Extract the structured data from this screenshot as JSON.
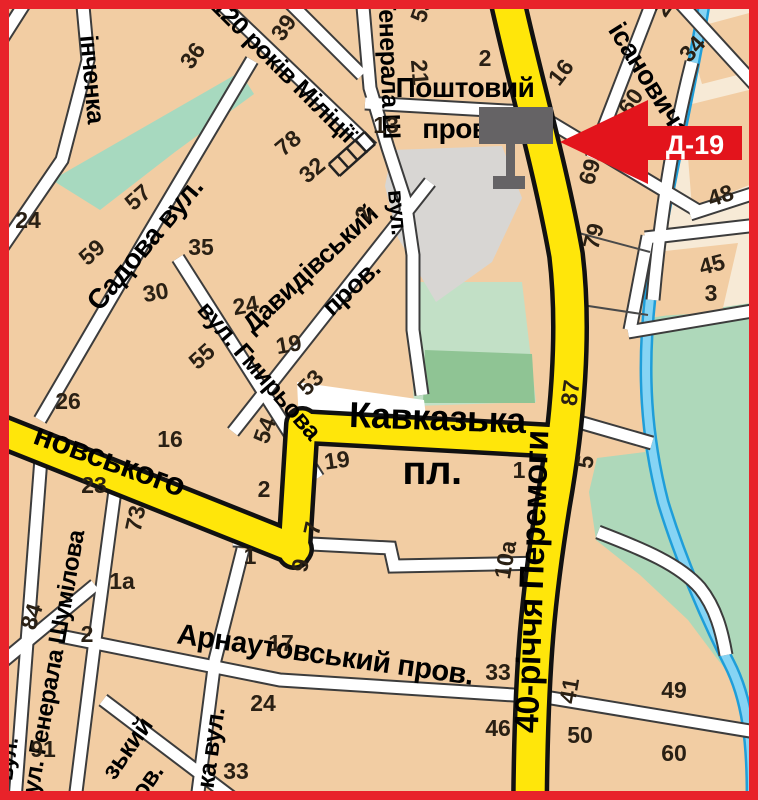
{
  "title": "city-map-billboard-location",
  "marker": {
    "code": "Д-19"
  },
  "colors": {
    "border_red": "#e8232a",
    "land_tan": "#f2cda3",
    "land_cream": "#f7ead6",
    "road_yellow": "#ffe60a",
    "street_white": "#ffffff",
    "park_green": "#aed8ba",
    "park_green_light": "#c2e0c6",
    "park_green_dark": "#8fc494",
    "water_blue": "#86d4f4",
    "water_edge": "#1f9ed9",
    "gray_zone": "#d8d6d3",
    "billboard_gray": "#656365",
    "marker_red": "#e3141c"
  },
  "street_labels": [
    {
      "text": "інченка",
      "x": 84,
      "y": 80,
      "rot": 85,
      "size": 25
    },
    {
      "text": "Садова вул.",
      "x": 152,
      "y": 250,
      "rot": -50,
      "size": 28
    },
    {
      "text": "120 років Міліції",
      "x": 278,
      "y": 76,
      "rot": 45,
      "size": 25
    },
    {
      "text": "Генерала Ш",
      "x": 381,
      "y": 68,
      "rot": 88,
      "size": 25
    },
    {
      "text": "вул.",
      "x": 390,
      "y": 213,
      "rot": 85,
      "size": 23
    },
    {
      "text": "Поштовий",
      "x": 465,
      "y": 97,
      "rot": 0,
      "size": 28
    },
    {
      "text": "пров.",
      "x": 459,
      "y": 138,
      "rot": 0,
      "size": 28
    },
    {
      "text": "ісановича",
      "x": 642,
      "y": 85,
      "rot": 58,
      "size": 27
    },
    {
      "text": "Давидівський",
      "x": 316,
      "y": 275,
      "rot": -43,
      "size": 26
    },
    {
      "text": "пров.",
      "x": 357,
      "y": 294,
      "rot": -43,
      "size": 26
    },
    {
      "text": "вул. Гмирьова",
      "x": 253,
      "y": 376,
      "rot": 49,
      "size": 25
    },
    {
      "text": "Кавказька",
      "x": 437,
      "y": 430,
      "rot": 2,
      "size": 36
    },
    {
      "text": "пл.",
      "x": 432,
      "y": 484,
      "rot": 0,
      "size": 40
    },
    {
      "text": "новського",
      "x": 106,
      "y": 470,
      "rot": 20,
      "size": 32
    },
    {
      "text": "40-річчя Перемоги",
      "x": 543,
      "y": 582,
      "rot": -88,
      "size": 34
    },
    {
      "text": "вул. Генерала Шумілова",
      "x": 60,
      "y": 670,
      "rot": -80,
      "size": 24
    },
    {
      "text": "Арнаутовський пров.",
      "x": 324,
      "y": 664,
      "rot": 8,
      "size": 29
    },
    {
      "text": "зький",
      "x": 134,
      "y": 753,
      "rot": -55,
      "size": 25
    },
    {
      "text": "ов.",
      "x": 154,
      "y": 786,
      "rot": -55,
      "size": 25
    },
    {
      "text": "ка вул.",
      "x": 219,
      "y": 749,
      "rot": -82,
      "size": 25
    },
    {
      "text": "вул.",
      "x": 15,
      "y": 760,
      "rot": -82,
      "size": 22
    }
  ],
  "house_numbers": [
    {
      "text": "36",
      "x": 199,
      "y": 60,
      "rot": -55
    },
    {
      "text": "39",
      "x": 290,
      "y": 32,
      "rot": -55
    },
    {
      "text": "78",
      "x": 293,
      "y": 149,
      "rot": -40
    },
    {
      "text": "32",
      "x": 317,
      "y": 176,
      "rot": -40
    },
    {
      "text": "24",
      "x": 28,
      "y": 228,
      "rot": 0
    },
    {
      "text": "57",
      "x": 143,
      "y": 203,
      "rot": -42
    },
    {
      "text": "59",
      "x": 97,
      "y": 258,
      "rot": -42
    },
    {
      "text": "35",
      "x": 201,
      "y": 255,
      "rot": 0
    },
    {
      "text": "30",
      "x": 157,
      "y": 300,
      "rot": -10
    },
    {
      "text": "55",
      "x": 207,
      "y": 362,
      "rot": -42
    },
    {
      "text": "53",
      "x": 429,
      "y": 12,
      "rot": -70
    },
    {
      "text": "21",
      "x": 412,
      "y": 73,
      "rot": 85
    },
    {
      "text": "2",
      "x": 485,
      "y": 66,
      "rot": 0
    },
    {
      "text": "13",
      "x": 386,
      "y": 133,
      "rot": 0
    },
    {
      "text": "16",
      "x": 567,
      "y": 77,
      "rot": -52
    },
    {
      "text": "2",
      "x": 669,
      "y": 13,
      "rot": -55
    },
    {
      "text": "34",
      "x": 698,
      "y": 54,
      "rot": -48
    },
    {
      "text": "60",
      "x": 637,
      "y": 106,
      "rot": -55
    },
    {
      "text": "69",
      "x": 597,
      "y": 174,
      "rot": -73
    },
    {
      "text": "79",
      "x": 601,
      "y": 238,
      "rot": -76
    },
    {
      "text": "48",
      "x": 723,
      "y": 203,
      "rot": -18
    },
    {
      "text": "45",
      "x": 714,
      "y": 272,
      "rot": -15
    },
    {
      "text": "3",
      "x": 711,
      "y": 301,
      "rot": 0
    },
    {
      "text": "87",
      "x": 578,
      "y": 394,
      "rot": -82
    },
    {
      "text": "5",
      "x": 593,
      "y": 463,
      "rot": -82
    },
    {
      "text": "2",
      "x": 371,
      "y": 216,
      "rot": -70
    },
    {
      "text": "24",
      "x": 247,
      "y": 313,
      "rot": -10
    },
    {
      "text": "19",
      "x": 290,
      "y": 352,
      "rot": -10
    },
    {
      "text": "53",
      "x": 316,
      "y": 388,
      "rot": -45
    },
    {
      "text": "26",
      "x": 68,
      "y": 409,
      "rot": 0
    },
    {
      "text": "16",
      "x": 170,
      "y": 447,
      "rot": 0
    },
    {
      "text": "54",
      "x": 272,
      "y": 433,
      "rot": -70
    },
    {
      "text": "23",
      "x": 94,
      "y": 493,
      "rot": 0
    },
    {
      "text": "73",
      "x": 143,
      "y": 520,
      "rot": -78
    },
    {
      "text": "2",
      "x": 264,
      "y": 497,
      "rot": 0
    },
    {
      "text": "1",
      "x": 250,
      "y": 564,
      "rot": 0
    },
    {
      "text": "1а",
      "x": 122,
      "y": 589,
      "rot": 0
    },
    {
      "text": "19",
      "x": 338,
      "y": 468,
      "rot": -8
    },
    {
      "text": "7",
      "x": 320,
      "y": 530,
      "rot": -78
    },
    {
      "text": "9",
      "x": 308,
      "y": 567,
      "rot": -78
    },
    {
      "text": "1",
      "x": 519,
      "y": 478,
      "rot": 0
    },
    {
      "text": "10а",
      "x": 513,
      "y": 561,
      "rot": -80
    },
    {
      "text": "84",
      "x": 39,
      "y": 619,
      "rot": -72
    },
    {
      "text": "2",
      "x": 87,
      "y": 642,
      "rot": 0
    },
    {
      "text": "91",
      "x": 43,
      "y": 757,
      "rot": 0
    },
    {
      "text": "17",
      "x": 281,
      "y": 651,
      "rot": 0
    },
    {
      "text": "24",
      "x": 263,
      "y": 711,
      "rot": 0
    },
    {
      "text": "33",
      "x": 236,
      "y": 779,
      "rot": 0
    },
    {
      "text": "33",
      "x": 498,
      "y": 680,
      "rot": 0
    },
    {
      "text": "41",
      "x": 577,
      "y": 692,
      "rot": -80
    },
    {
      "text": "46",
      "x": 498,
      "y": 736,
      "rot": 0
    },
    {
      "text": "50",
      "x": 580,
      "y": 743,
      "rot": 0
    },
    {
      "text": "49",
      "x": 674,
      "y": 698,
      "rot": 0
    },
    {
      "text": "60",
      "x": 674,
      "y": 761,
      "rot": 0
    }
  ]
}
